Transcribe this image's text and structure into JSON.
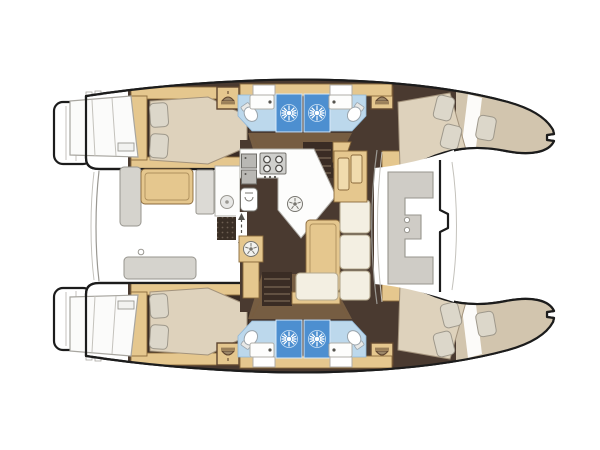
{
  "diagram": {
    "type": "catamaran-yacht-floor-plan",
    "orientation": "bow-pointing-right",
    "hulls": [
      {
        "name": "port-hull",
        "rooms": [
          "aft-double-cabin",
          "bathroom-with-two-showers-and-two-toilets",
          "forward-double-cabin",
          "bow-berth"
        ]
      },
      {
        "name": "starboard-hull",
        "rooms": [
          "aft-double-cabin",
          "bathroom-with-two-showers-and-two-toilets",
          "forward-double-cabin",
          "bow-berth"
        ]
      }
    ],
    "bridgedeck": {
      "aft_cockpit": [
        "cockpit-table",
        "l-bench",
        "aft-bench",
        "wet-bar-sink",
        "grill-grate",
        "helm-panel"
      ],
      "salon": [
        "l-shaped-galley-counter",
        "four-burner-stove",
        "galley-sink",
        "dining-table",
        "l-shaped-sofa",
        "sideboard",
        "companionway-steps-port",
        "companionway-steps-starboard",
        "entry-door-arrow"
      ],
      "forward_cockpit": [
        "c-shaped-seat",
        "cup-holders",
        "forward-crossbeam"
      ]
    }
  },
  "icons": {
    "shower_head": "sunburst-icon",
    "wardrobe": "hanger-icon",
    "burner_or_drain": "spoked-circle-icon",
    "entry_direction": "double-arrow-icon"
  },
  "colors": {
    "bg": "#ffffff",
    "hull_fill": "#ffffff",
    "outline": "#1c1c1c",
    "floor_dark": "#4a3a30",
    "floor_darker": "#3a2c24",
    "wood": "#e5c78e",
    "wood_light": "#f0dbad",
    "mattress": "#ded2bc",
    "pillow": "#dcd7ca",
    "bow_deck": "#d2c5ae",
    "gray_seat": "#d5d3cd",
    "cream_cushion": "#f3efe2",
    "counter_white": "#fdfdfc",
    "appliance_gray": "#c3c2bf",
    "shower_blue": "#4d8fd0",
    "shower_floor": "#bcd8ec",
    "toilet_white": "#ffffff",
    "corridor_tan": "#b28e5e",
    "grate_dark": "#3a2f26",
    "grate_dot": "#6b5d50",
    "window_pane": "#fbfbfa"
  }
}
